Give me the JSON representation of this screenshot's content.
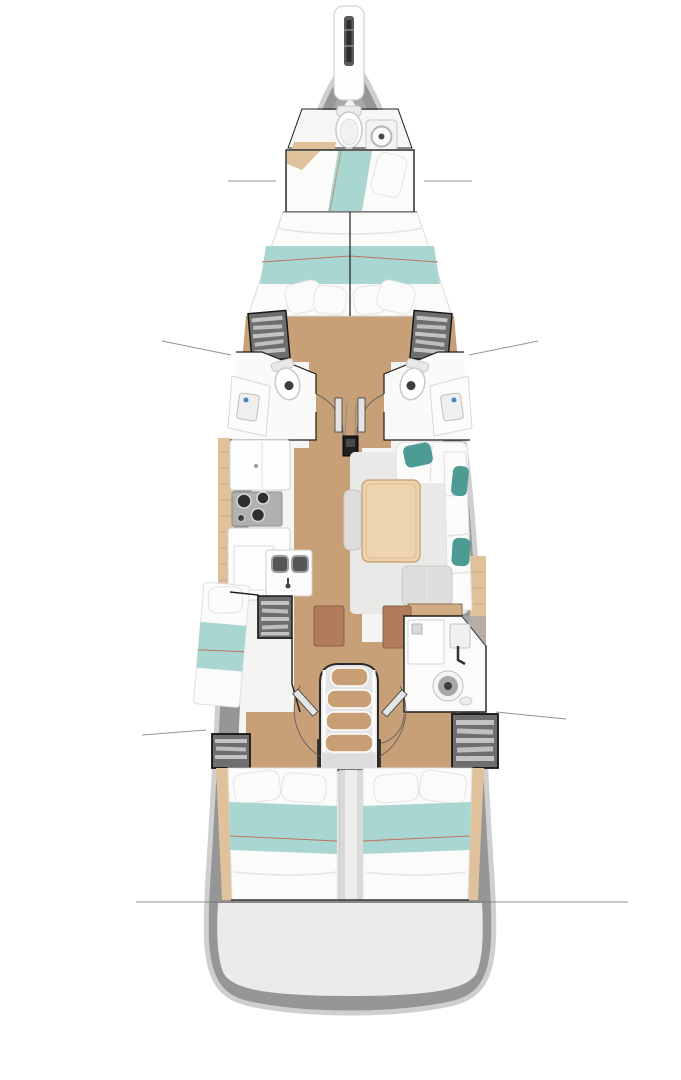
{
  "diagram": {
    "type": "yacht-interior-deck-plan",
    "orientation": "bow-up",
    "areas": [
      "bowsprit",
      "foredeck",
      "forward-head",
      "forepeak-berth",
      "owner-v-berth-cabin",
      "port-forward-head",
      "starboard-forward-head",
      "mast-post",
      "galley",
      "salon-dinette",
      "port-midship-berth",
      "chart-bench",
      "aft-head",
      "companionway-stairs",
      "engine-compartment",
      "port-aft-cabin",
      "starboard-aft-cabin",
      "transom"
    ],
    "features": {
      "stair_steps": 4,
      "stove_burners": 3,
      "heads_count": 3,
      "double_berths": 4,
      "wardrobe_lockers": 5,
      "door_swings": 5,
      "callout_leader_lines": 7,
      "dining_tables": 1
    }
  },
  "colors": {
    "background": "#ffffff",
    "hull": "#969696",
    "hull_rim": "#cfcfcf",
    "interior": "#f4f4f3",
    "transom": "#ebebea",
    "wood_floor": "#c7a078",
    "wood_light": "#dfc19b",
    "wood_table": "#edd3ae",
    "bedding_white": "#fbfbfa",
    "blanket_teal": "#a9d6d0",
    "pillow_teal": "#4c9c93",
    "piping_red": "#c4705e",
    "locker_grey": "#6e6e6e",
    "locker_slat": "#d2d2d2",
    "outline_dark": "#1c1c1c",
    "fixture_white": "#fdfdfd",
    "sink_dark": "#565656",
    "brown_panel": "#b17c5c",
    "stair_wood": "#c89e74",
    "engine_grey": "#d9d9d8",
    "callout_line": "#6f6f6f",
    "faucet_blue": "#4a84c4",
    "rug": "#e9e9e7"
  }
}
